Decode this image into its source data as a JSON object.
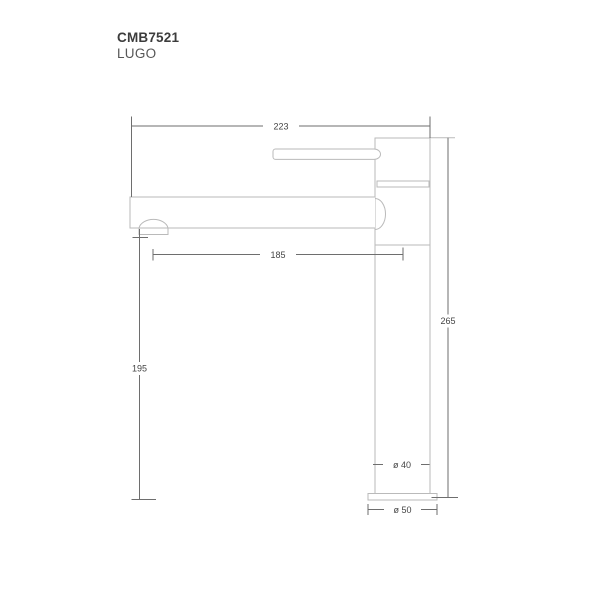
{
  "header": {
    "product_code": "CMB7521",
    "product_name": "LUGO"
  },
  "drawing": {
    "description": "Side-view dimensional line drawing of a tall single-lever basin mixer tap with side handle, straight spout and round base plate",
    "units": "mm",
    "colors": {
      "outline": "#bababa",
      "dimension": "#6e6e6e",
      "label_text": "#454545",
      "background": "#ffffff"
    },
    "dimensions": {
      "total_projection": "223",
      "spout_reach": "185",
      "spout_height": "195",
      "total_height": "265",
      "body_diameter": "ø 40",
      "base_diameter": "ø 50"
    }
  }
}
